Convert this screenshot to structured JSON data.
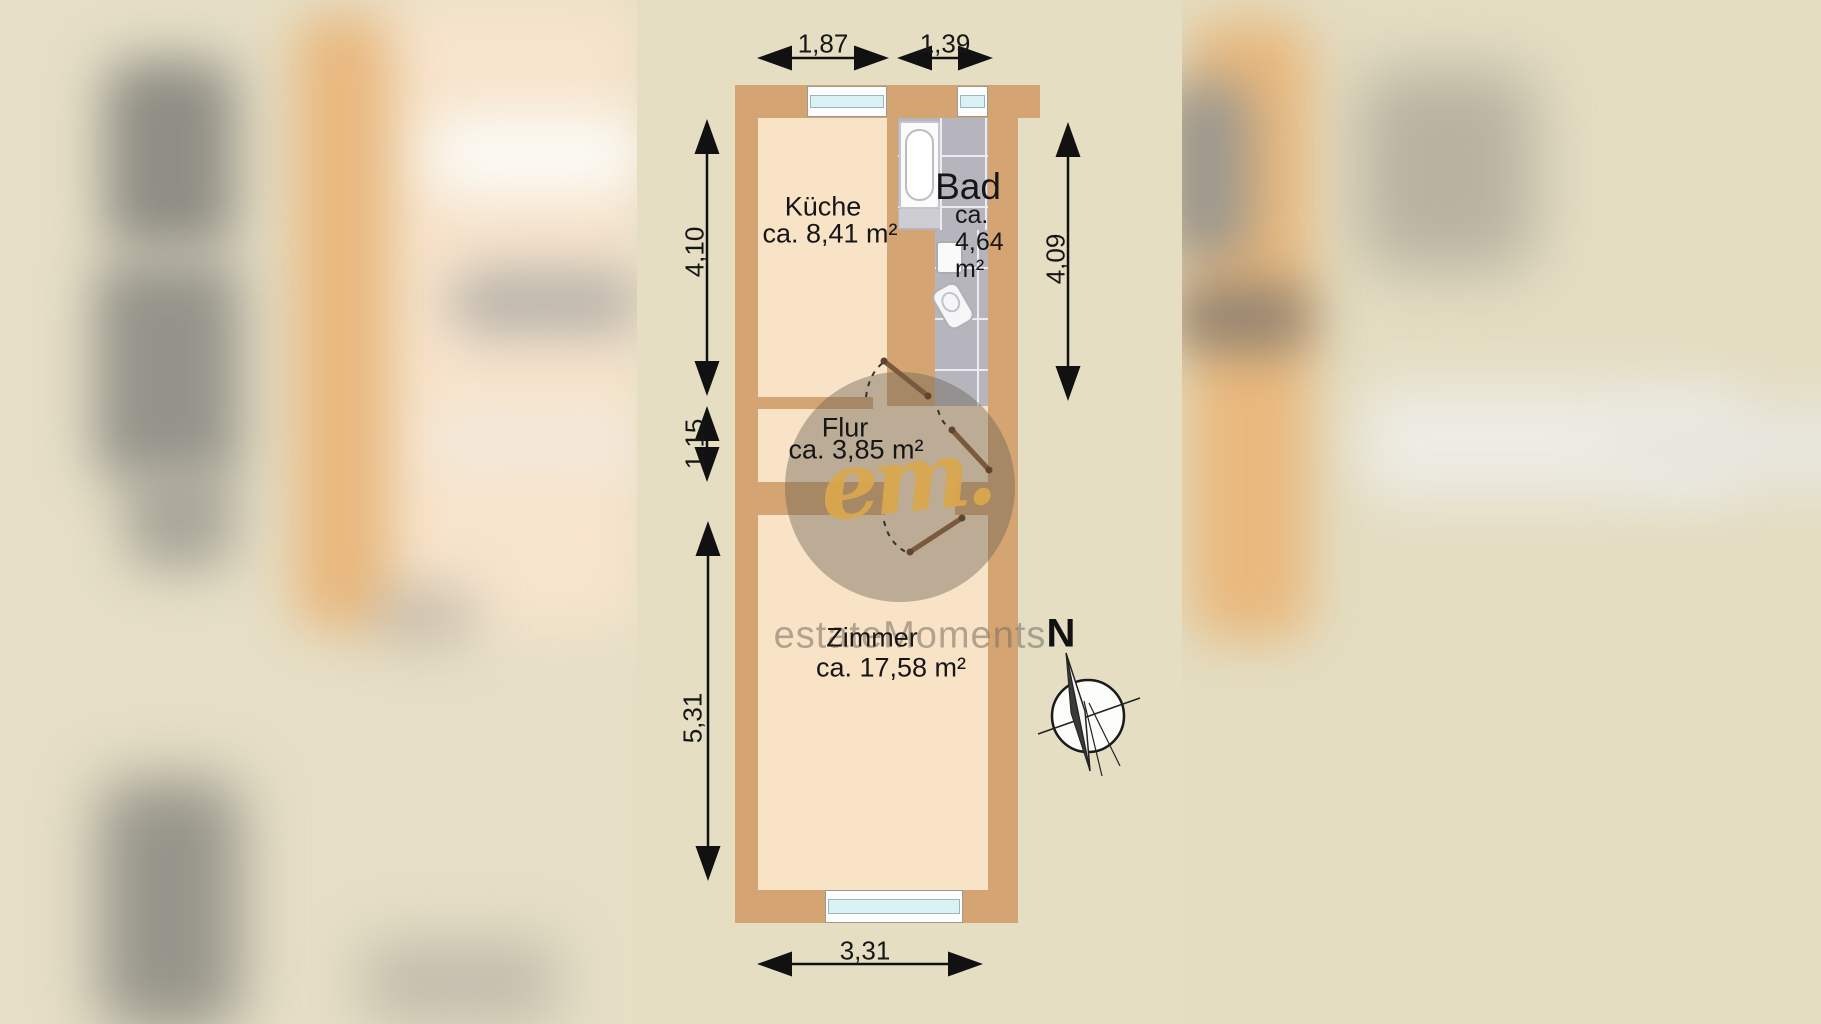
{
  "rooms": {
    "kueche": {
      "name": "Küche",
      "area": "ca. 8,41 m²"
    },
    "bad": {
      "name": "Bad",
      "area_line1": "ca.",
      "area_line2": "4,64",
      "area_line3": "m²"
    },
    "flur": {
      "name": "Flur",
      "area": "ca. 3,85 m²"
    },
    "zimmer": {
      "name": "Zimmer",
      "area": "ca. 17,58 m²"
    }
  },
  "dimensions": {
    "top_kueche": "1,87",
    "top_bad": "1,39",
    "left_kueche": "4,10",
    "left_flur": "1,15",
    "left_zimmer": "5,31",
    "right_bad": "4,09",
    "bottom_zimmer": "3,31"
  },
  "compass": {
    "north_label": "N"
  },
  "watermark": {
    "logo_script": "em.",
    "brand": "estateMoments"
  },
  "colors": {
    "wall": "#d4a572",
    "room_interior": "#f8e3c6",
    "tile": "#b6b5bd",
    "window_glass": "#dbf2f5",
    "panel_background": "#e5dec3",
    "watermark_gold": "#d8a64d",
    "dimension_text": "#161616"
  }
}
